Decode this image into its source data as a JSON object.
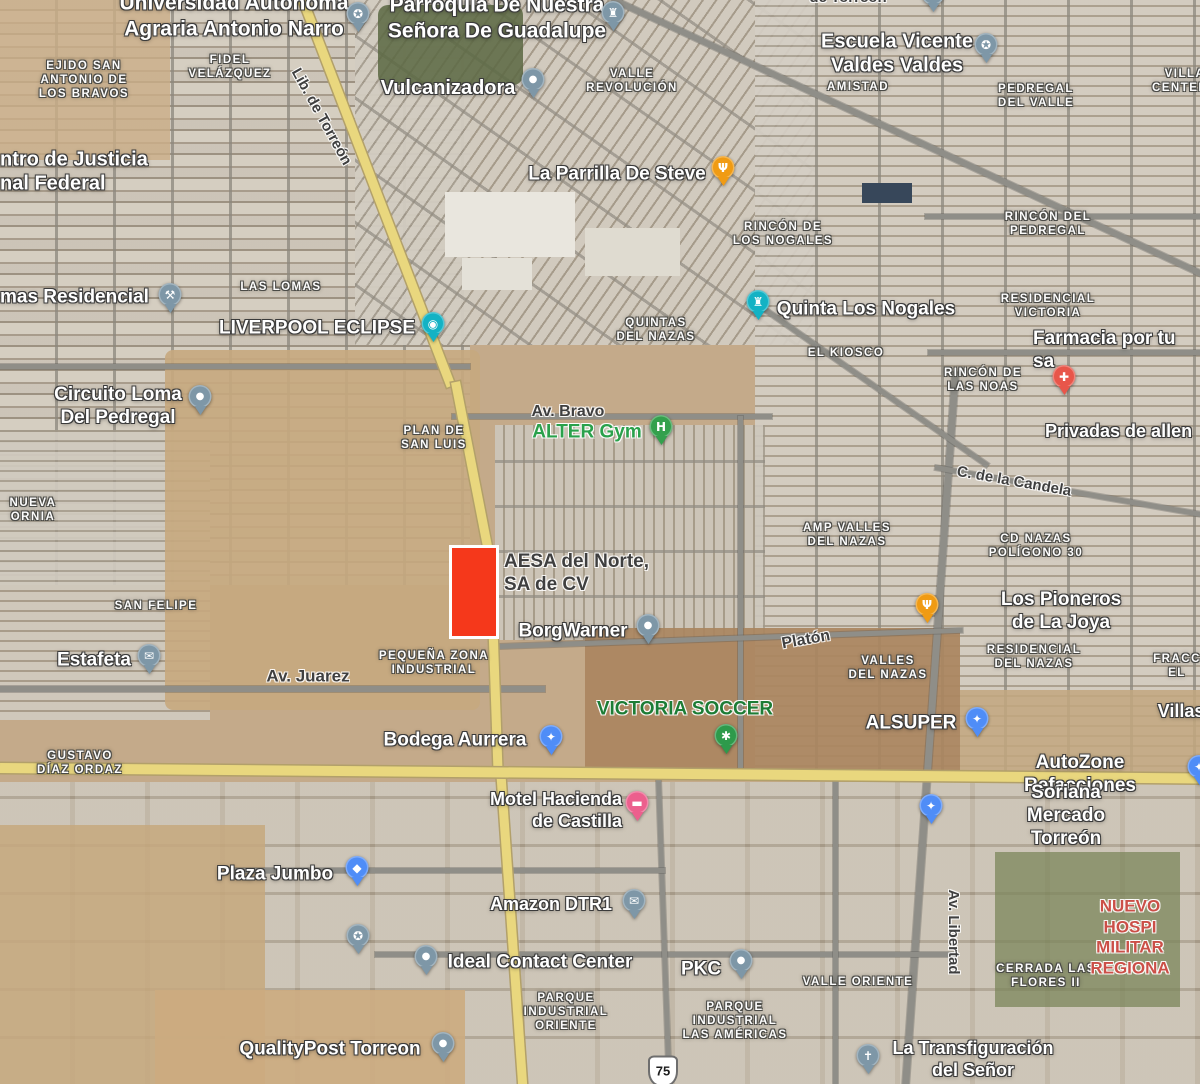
{
  "map": {
    "palette": {
      "desert": "#c4aa8a",
      "urban_gray": "#cdc7ba",
      "road_gray": "#8f8e88",
      "highway_yellow": "#e9d77e",
      "highlight_red": "#f5381b",
      "highlight_border": "#ffffff",
      "poi_blue_gray": "#7e97a7",
      "shopping_blue": "#4f8df7",
      "restaurant_orange": "#f09b13",
      "attraction_teal": "#13b2c4",
      "pharmacy_red": "#e8564a",
      "gym_green": "#34a04d",
      "hotel_pink": "#ec5f8d",
      "green_label": "#2aa14b",
      "dark_green_label": "#1d7c35",
      "hospital_red_label": "#cb4f47"
    },
    "highlight": {
      "x": 449,
      "y": 545,
      "width": 44,
      "height": 88,
      "fill": "#f5381b",
      "border_color": "#ffffff"
    },
    "route_shield": {
      "text": "75",
      "x": 663,
      "y": 1071
    },
    "labels": [
      {
        "id": "ejido-san-antonio",
        "kind": "area",
        "text": "EJIDO SAN\nANTONIO DE\nLOS BRAVOS",
        "x": 84,
        "y": 80
      },
      {
        "id": "fidel-velazquez",
        "kind": "area",
        "text": "FIDEL\nVELÁZQUEZ",
        "x": 230,
        "y": 67
      },
      {
        "id": "valle-revolucion",
        "kind": "area",
        "text": "VALLE\nREVOLUCIÓN",
        "x": 632,
        "y": 81
      },
      {
        "id": "amistad",
        "kind": "area",
        "text": "AMISTAD",
        "x": 858,
        "y": 87
      },
      {
        "id": "pedregal-del-valle",
        "kind": "area",
        "text": "PEDREGAL\nDEL VALLE",
        "x": 1036,
        "y": 96
      },
      {
        "id": "villa-centenario",
        "kind": "area",
        "text": "VILLA\nCENTENA",
        "x": 1185,
        "y": 81
      },
      {
        "id": "rincon-de-los-nogales",
        "kind": "area",
        "text": "RINCÓN DE\nLOS NOGALES",
        "x": 783,
        "y": 234
      },
      {
        "id": "rincon-del-pedregal",
        "kind": "area",
        "text": "RINCÓN DEL\nPEDREGAL",
        "x": 1048,
        "y": 224
      },
      {
        "id": "las-lomas",
        "kind": "area",
        "text": "LAS LOMAS",
        "x": 281,
        "y": 287
      },
      {
        "id": "quintas-del-nazas",
        "kind": "area",
        "text": "QUINTAS\nDEL NAZAS",
        "x": 656,
        "y": 330
      },
      {
        "id": "el-kiosco",
        "kind": "area",
        "text": "EL KIOSCO",
        "x": 846,
        "y": 353
      },
      {
        "id": "residencial-victoria",
        "kind": "area",
        "text": "RESIDENCIAL\nVICTORIA",
        "x": 1048,
        "y": 306
      },
      {
        "id": "rincon-de-las-noas",
        "kind": "area",
        "text": "RINCÓN DE\nLAS NOAS",
        "x": 983,
        "y": 380
      },
      {
        "id": "plan-de-san-luis",
        "kind": "area",
        "text": "PLAN DE\nSAN LUIS",
        "x": 434,
        "y": 438
      },
      {
        "id": "nueva-ornia",
        "kind": "area",
        "text": "NUEVA\nORNIA",
        "x": 33,
        "y": 510
      },
      {
        "id": "amp-valles-del-nazas",
        "kind": "area",
        "text": "AMP VALLES\nDEL NAZAS",
        "x": 847,
        "y": 535
      },
      {
        "id": "cd-nazas-poligono-30",
        "kind": "area",
        "text": "CD NAZAS\nPOLÍGONO 30",
        "x": 1036,
        "y": 546
      },
      {
        "id": "san-felipe",
        "kind": "area",
        "text": "SAN FELIPE",
        "x": 156,
        "y": 606
      },
      {
        "id": "pequena-zona-industrial",
        "kind": "area",
        "text": "PEQUEÑA ZONA\nINDUSTRIAL",
        "x": 434,
        "y": 663
      },
      {
        "id": "valles-del-nazas",
        "kind": "area",
        "text": "VALLES\nDEL NAZAS",
        "x": 888,
        "y": 668
      },
      {
        "id": "residencial-del-nazas",
        "kind": "area",
        "text": "RESIDENCIAL\nDEL NAZAS",
        "x": 1034,
        "y": 657
      },
      {
        "id": "fracc-el",
        "kind": "area",
        "text": "FRACC\nEL",
        "x": 1177,
        "y": 666
      },
      {
        "id": "gustavo-diaz-ordaz",
        "kind": "area",
        "text": "GUSTAVO\nDÍAZ ORDAZ",
        "x": 80,
        "y": 763
      },
      {
        "id": "valle-oriente",
        "kind": "area",
        "text": "VALLE ORIENTE",
        "x": 858,
        "y": 982
      },
      {
        "id": "parque-industrial-oriente",
        "kind": "area",
        "text": "PARQUE\nINDUSTRIAL\nORIENTE",
        "x": 566,
        "y": 1012
      },
      {
        "id": "parque-industrial-las-americas",
        "kind": "area",
        "text": "PARQUE\nINDUSTRIAL\nLAS AMÉRICAS",
        "x": 735,
        "y": 1021
      },
      {
        "id": "cerrada-las-flores-ii",
        "kind": "area",
        "text": "CERRADA LAS\nFLORES II",
        "x": 1046,
        "y": 976
      },
      {
        "id": "universidad-autonoma",
        "kind": "poi",
        "text": "Universidad Autonoma\nAgraria Antonio Narro",
        "x": 234,
        "y": 16,
        "size": 21
      },
      {
        "id": "parroquia-guadalupe",
        "kind": "poi",
        "text": "Parroquia De Nuestra\nSeñora De Guadalupe",
        "x": 497,
        "y": 18,
        "size": 21
      },
      {
        "id": "vulcanizadora",
        "kind": "poi",
        "text": "Vulcanizadora",
        "x": 448,
        "y": 88,
        "size": 20
      },
      {
        "id": "escuela-vicente-valdes",
        "kind": "poi",
        "text": "Escuela Vicente\nValdes Valdes",
        "x": 897,
        "y": 54,
        "size": 20
      },
      {
        "id": "la-parrilla-de-steve",
        "kind": "poi",
        "text": "La Parrilla De Steve",
        "x": 617,
        "y": 174,
        "size": 19
      },
      {
        "id": "centro-de-justicia",
        "kind": "poi",
        "text": "ntro de Justicia\nnal Federal",
        "x": 0,
        "y": 172,
        "align": "left",
        "size": 20
      },
      {
        "id": "lomas-residencial",
        "kind": "poi",
        "text": "mas Residencial",
        "x": 0,
        "y": 297,
        "align": "left",
        "size": 19
      },
      {
        "id": "liverpool-eclipse",
        "kind": "poi",
        "text": "LIVERPOOL ECLIPSE",
        "x": 317,
        "y": 328,
        "size": 19
      },
      {
        "id": "circuito-loma-del-pedregal",
        "kind": "poi",
        "text": "Circuito Loma\nDel Pedregal",
        "x": 118,
        "y": 406,
        "size": 19
      },
      {
        "id": "quinta-los-nogales",
        "kind": "poi",
        "text": "Quinta Los Nogales",
        "x": 866,
        "y": 309,
        "size": 19
      },
      {
        "id": "farmacia-por-tu-salud",
        "kind": "poi",
        "text": "Farmacia por tu sa",
        "x": 1033,
        "y": 350,
        "align": "left",
        "size": 19
      },
      {
        "id": "privadas-de-allende",
        "kind": "poi",
        "text": "Privadas de allen",
        "x": 1045,
        "y": 432,
        "align": "left",
        "size": 18
      },
      {
        "id": "borgwarner",
        "kind": "poi",
        "text": "BorgWarner",
        "x": 573,
        "y": 631,
        "size": 19
      },
      {
        "id": "los-pioneros-de-la-joya",
        "kind": "poi",
        "text": "Los Pioneros de La Joya",
        "x": 1061,
        "y": 611,
        "size": 19
      },
      {
        "id": "estafeta",
        "kind": "poi",
        "text": "Estafeta",
        "x": 94,
        "y": 660,
        "size": 19
      },
      {
        "id": "alsuper",
        "kind": "poi",
        "text": "ALSUPER",
        "x": 911,
        "y": 723,
        "size": 19
      },
      {
        "id": "bodega-aurrera",
        "kind": "poi",
        "text": "Bodega Aurrera",
        "x": 455,
        "y": 740,
        "size": 19
      },
      {
        "id": "autozone-refacciones",
        "kind": "poi",
        "text": "AutoZone Refacciones",
        "x": 1080,
        "y": 774,
        "size": 19
      },
      {
        "id": "motel-hacienda-de-castilla",
        "kind": "poi",
        "text": "Motel Hacienda\nde Castilla",
        "x": 622,
        "y": 811,
        "align": "right",
        "size": 18
      },
      {
        "id": "soriana-mercado-torreon",
        "kind": "poi",
        "text": "Soriana Mercado Torreón",
        "x": 1066,
        "y": 816,
        "size": 19
      },
      {
        "id": "villas",
        "kind": "poi",
        "text": "Villas",
        "x": 1181,
        "y": 712,
        "size": 18
      },
      {
        "id": "plaza-jumbo",
        "kind": "poi",
        "text": "Plaza Jumbo",
        "x": 275,
        "y": 874,
        "size": 19
      },
      {
        "id": "amazon-dtr1",
        "kind": "poi",
        "text": "Amazon DTR1",
        "x": 551,
        "y": 905,
        "size": 18
      },
      {
        "id": "ideal-contact-center",
        "kind": "poi",
        "text": "Ideal Contact Center",
        "x": 540,
        "y": 962,
        "size": 19
      },
      {
        "id": "pkc",
        "kind": "poi",
        "text": "PKC",
        "x": 701,
        "y": 969,
        "size": 19
      },
      {
        "id": "qualitypost-torreon",
        "kind": "poi",
        "text": "QualityPost Torreon",
        "x": 330,
        "y": 1049,
        "size": 19
      },
      {
        "id": "la-transfiguracion-del-senor",
        "kind": "poi",
        "text": "La Transfiguración\ndel Señor",
        "x": 973,
        "y": 1060,
        "size": 18
      },
      {
        "id": "alter-gym",
        "kind": "poi-green",
        "text": "ALTER Gym",
        "x": 587,
        "y": 432,
        "size": 19,
        "color": "#2aa14b"
      },
      {
        "id": "victoria-soccer",
        "kind": "poi-green",
        "text": "VICTORIA SOCCER",
        "x": 685,
        "y": 709,
        "size": 19,
        "color": "#1d7c35"
      },
      {
        "id": "nuevo-hospital-militar",
        "kind": "poi-red",
        "text": "NUEVO HOSPI\nMILITAR REGIONA",
        "x": 1130,
        "y": 938,
        "size": 17,
        "color": "#cb4f47"
      },
      {
        "id": "aesa-del-norte",
        "kind": "poi-dark",
        "text": "AESA del Norte,\nSA de CV",
        "x": 504,
        "y": 573,
        "align": "left",
        "size": 19
      },
      {
        "id": "lib-de-torreon",
        "kind": "road-lbl",
        "text": "Lib. de Torreón",
        "x": 321,
        "y": 117,
        "rotate": 61,
        "size": 15
      },
      {
        "id": "av-bravo",
        "kind": "road-lbl",
        "text": "Av. Bravo",
        "x": 568,
        "y": 412,
        "size": 16
      },
      {
        "id": "av-juarez",
        "kind": "road-lbl",
        "text": "Av. Juarez",
        "x": 308,
        "y": 677,
        "size": 17
      },
      {
        "id": "platon",
        "kind": "road-lbl",
        "text": "Platón",
        "x": 806,
        "y": 640,
        "rotate": -10,
        "size": 16
      },
      {
        "id": "c-de-la-candela",
        "kind": "road-lbl",
        "text": "C. de la Candela",
        "x": 1014,
        "y": 482,
        "rotate": 10,
        "size": 15
      },
      {
        "id": "av-libertad",
        "kind": "road-lbl",
        "text": "Av. Libertad",
        "x": 953,
        "y": 932,
        "rotate": 90,
        "size": 15
      },
      {
        "id": "torreon-fragment",
        "kind": "road-lbl",
        "text": "de Torreón",
        "x": 848,
        "y": -2,
        "size": 15
      }
    ],
    "pins": [
      {
        "name": "universidad-pin",
        "icon": "graduation-cap-icon",
        "glyph": "✪",
        "color": "#7e97a7",
        "x": 358,
        "y": 14
      },
      {
        "name": "parroquia-pin",
        "icon": "church-icon",
        "glyph": "♜",
        "color": "#7e97a7",
        "x": 613,
        "y": 13
      },
      {
        "name": "cut-pin-top",
        "icon": "dot-icon",
        "glyph": "●",
        "color": "#7e97a7",
        "x": 933,
        "y": -6
      },
      {
        "name": "vulcanizadora-pin",
        "icon": "dot-icon",
        "glyph": "●",
        "color": "#7e97a7",
        "x": 533,
        "y": 80
      },
      {
        "name": "escuela-pin",
        "icon": "graduation-cap-icon",
        "glyph": "✪",
        "color": "#7e97a7",
        "x": 986,
        "y": 45
      },
      {
        "name": "la-parrilla-pin",
        "icon": "restaurant-icon",
        "glyph": "Ψ",
        "color": "#f09b13",
        "x": 723,
        "y": 168
      },
      {
        "name": "lomas-residencial-pin",
        "icon": "tools-icon",
        "glyph": "⚒",
        "color": "#7e97a7",
        "x": 170,
        "y": 295
      },
      {
        "name": "liverpool-eclipse-pin",
        "icon": "camera-icon",
        "glyph": "◉",
        "color": "#13b2c4",
        "x": 433,
        "y": 324
      },
      {
        "name": "circuito-loma-pin",
        "icon": "dot-icon",
        "glyph": "●",
        "color": "#7e97a7",
        "x": 200,
        "y": 397
      },
      {
        "name": "quinta-nogales-pin",
        "icon": "castle-icon",
        "glyph": "♜",
        "color": "#13b2c4",
        "x": 758,
        "y": 302
      },
      {
        "name": "farmacia-pin",
        "icon": "pharmacy-icon",
        "glyph": "✚",
        "color": "#e8564a",
        "x": 1064,
        "y": 377
      },
      {
        "name": "alter-gym-pin",
        "icon": "dumbbell-icon",
        "glyph": "H",
        "color": "#34a04d",
        "x": 661,
        "y": 427
      },
      {
        "name": "borgwarner-pin",
        "icon": "dot-icon",
        "glyph": "●",
        "color": "#7e97a7",
        "x": 648,
        "y": 626
      },
      {
        "name": "pioneros-pin",
        "icon": "restaurant-icon",
        "glyph": "Ψ",
        "color": "#f09b13",
        "x": 927,
        "y": 605
      },
      {
        "name": "estafeta-pin",
        "icon": "mail-icon",
        "glyph": "✉",
        "color": "#7e97a7",
        "x": 149,
        "y": 656
      },
      {
        "name": "victoria-soccer-pin",
        "icon": "soccer-icon",
        "glyph": "✱",
        "color": "#2e9a4b",
        "x": 726,
        "y": 736
      },
      {
        "name": "alsuper-pin",
        "icon": "shopping-cart-icon",
        "glyph": "✦",
        "color": "#4f8df7",
        "x": 977,
        "y": 719
      },
      {
        "name": "bodega-aurrera-pin",
        "icon": "shopping-cart-icon",
        "glyph": "✦",
        "color": "#4f8df7",
        "x": 551,
        "y": 737
      },
      {
        "name": "autozone-pin-cut",
        "icon": "shopping-cart-icon",
        "glyph": "✦",
        "color": "#4f8df7",
        "x": 1199,
        "y": 767
      },
      {
        "name": "soriana-pin",
        "icon": "shopping-cart-icon",
        "glyph": "✦",
        "color": "#4f8df7",
        "x": 931,
        "y": 806
      },
      {
        "name": "motel-pin",
        "icon": "bed-icon",
        "glyph": "▬",
        "color": "#ec5f8d",
        "x": 637,
        "y": 803
      },
      {
        "name": "plaza-jumbo-pin",
        "icon": "shopping-bag-icon",
        "glyph": "◆",
        "color": "#4f8df7",
        "x": 357,
        "y": 868
      },
      {
        "name": "amazon-pin",
        "icon": "mail-icon",
        "glyph": "✉",
        "color": "#7e97a7",
        "x": 634,
        "y": 901
      },
      {
        "name": "school-pin-unlabeled",
        "icon": "graduation-cap-icon",
        "glyph": "✪",
        "color": "#7e97a7",
        "x": 358,
        "y": 936
      },
      {
        "name": "ideal-contact-pin",
        "icon": "dot-icon",
        "glyph": "●",
        "color": "#7e97a7",
        "x": 426,
        "y": 957
      },
      {
        "name": "pkc-pin",
        "icon": "dot-icon",
        "glyph": "●",
        "color": "#7e97a7",
        "x": 741,
        "y": 961
      },
      {
        "name": "qualitypost-pin",
        "icon": "dot-icon",
        "glyph": "●",
        "color": "#7e97a7",
        "x": 443,
        "y": 1044
      },
      {
        "name": "transfiguracion-pin",
        "icon": "cross-icon",
        "glyph": "✝",
        "color": "#7e97a7",
        "x": 868,
        "y": 1056
      }
    ]
  }
}
